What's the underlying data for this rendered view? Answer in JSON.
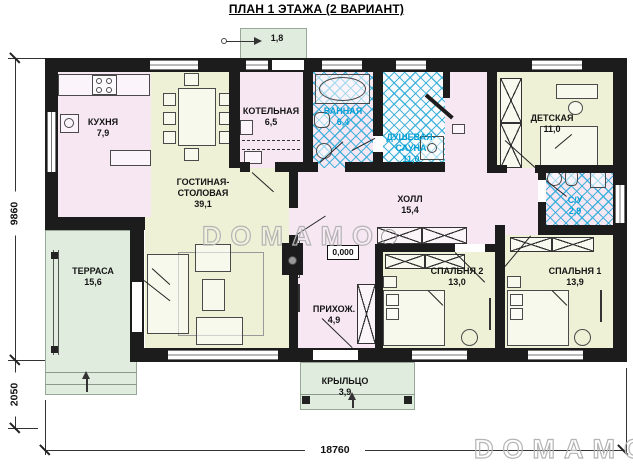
{
  "title": "ПЛАН 1 ЭТАЖА (2 ВАРИАНТ)",
  "watermark": "DOMAMO",
  "elevation_mark": "0,000",
  "dimensions": {
    "bottom_total": "18760",
    "left_main": "9860",
    "left_lower": "2050"
  },
  "annotations": {
    "top_porch_area": "1,8"
  },
  "rooms": {
    "kitchen": {
      "name": "КУХНЯ",
      "area": "7,9"
    },
    "living": {
      "name": "ГОСТИНАЯ-СТОЛОВАЯ",
      "area": "39,1"
    },
    "boiler": {
      "name": "КОТЕЛЬНАЯ",
      "area": "6,5"
    },
    "bathroom": {
      "name": "ВАННАЯ",
      "area": "6,4"
    },
    "sauna": {
      "name": "ДУШЕВАЯ-САУНА",
      "area": "11,0"
    },
    "kids": {
      "name": "ДЕТСКАЯ",
      "area": "11,0"
    },
    "hall": {
      "name": "ХОЛЛ",
      "area": "15,4"
    },
    "wc": {
      "name": "С/У",
      "area": "2,9"
    },
    "entry": {
      "name": "ПРИХОЖ.",
      "area": "4,9"
    },
    "bedroom2": {
      "name": "СПАЛЬНЯ 2",
      "area": "13,0"
    },
    "bedroom1": {
      "name": "СПАЛЬНЯ 1",
      "area": "13,9"
    },
    "terrace": {
      "name": "ТЕРРАСА",
      "area": "15,6"
    },
    "porch": {
      "name": "КРЫЛЬЦО",
      "area": "3,9"
    }
  },
  "colors": {
    "wall": "#1c1c1c",
    "room_pink": "#f6e7f3",
    "room_green": "#eef1d6",
    "outdoor_green": "#e0edde",
    "tile_blue": "#29aad8",
    "wet_label": "#00a0d6",
    "watermark_gray": "#b4b4b4"
  }
}
